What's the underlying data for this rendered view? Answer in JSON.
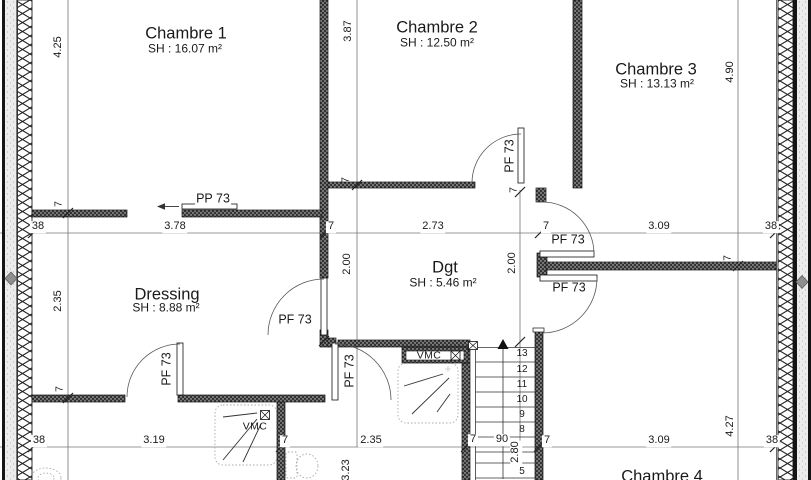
{
  "rooms": {
    "chambre1": {
      "name": "Chambre 1",
      "area": "SH : 16.07 m²"
    },
    "chambre2": {
      "name": "Chambre 2",
      "area": "SH : 12.50 m²"
    },
    "chambre3": {
      "name": "Chambre 3",
      "area": "SH : 13.13 m²"
    },
    "chambre4": {
      "name": "Chambre 4"
    },
    "dressing": {
      "name": "Dressing",
      "area": "SH : 8.88 m²"
    },
    "degagement": {
      "name": "Dgt",
      "area": "SH : 5.46 m²"
    }
  },
  "doors": {
    "chambre1_sliding": "PP 73",
    "chambre2": "PF 73",
    "chambre3": "PF 73",
    "chambre4": "PF 73",
    "dressing": "PF 73",
    "bathroom": "PF 73",
    "bottom_room": "PF 73"
  },
  "equipment": {
    "vmc_duct": "VMC",
    "vmc_unit": "VMC"
  },
  "stairs": {
    "steps": [
      "13",
      "12",
      "11",
      "10",
      "9",
      "8",
      "5"
    ]
  },
  "dimensions": {
    "top_row": [
      "38",
      "3.78",
      "7",
      "2.73",
      "7",
      "3.09",
      "38"
    ],
    "bottom_row": [
      "38",
      "3.19",
      "7",
      "2.35",
      "7",
      "90",
      "7",
      "3.09",
      "38"
    ],
    "left_col": [
      "4.25",
      "2.35"
    ],
    "mid_col": [
      "3.87",
      "2.00",
      "3.23"
    ],
    "stair_col": [
      "2.00",
      "2.80"
    ],
    "right_col": [
      "4.90",
      "4.27"
    ],
    "wall_thickness_ticks": [
      "7",
      "7",
      "7",
      "7",
      "7"
    ]
  }
}
